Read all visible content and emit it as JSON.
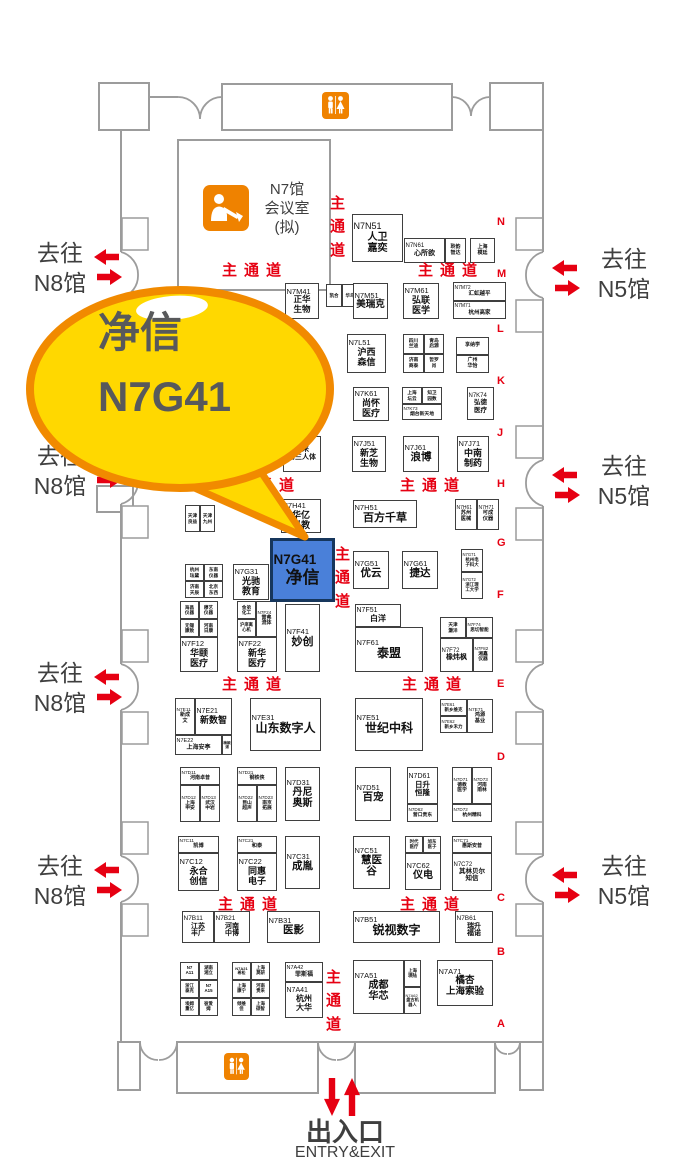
{
  "colors": {
    "red": "#e60012",
    "booth_blue": "#4a80d9",
    "booth_blue_border": "#16365c",
    "bubble_fill": "#ffd800",
    "bubble_stroke": "#f18a00",
    "facility_orange": "#ef8200",
    "wall_gray": "#9c9c9c",
    "text_dark": "#3f3f3f",
    "bubble_text": "#58595b"
  },
  "callout": {
    "name": "净信",
    "booth": "N7G41"
  },
  "conference_room": {
    "lines": [
      "N7馆",
      "会议室",
      "(拟)"
    ]
  },
  "icons": {
    "restroom": "wc-restroom",
    "conference": "presentation-speaker",
    "gate_arrows": "block-arrows",
    "entry_arrows": "up-down-arrows"
  },
  "aisle_label": "主通道",
  "aisles": {
    "h": [
      [
        222,
        259
      ],
      [
        418,
        259
      ],
      [
        235,
        474
      ],
      [
        400,
        474
      ],
      [
        222,
        673
      ],
      [
        402,
        673
      ],
      [
        218,
        893
      ],
      [
        400,
        893
      ]
    ],
    "v": [
      [
        329,
        192
      ],
      [
        334,
        543
      ],
      [
        325,
        966
      ]
    ]
  },
  "row_letters": [
    {
      "ch": "N",
      "y": 216
    },
    {
      "ch": "M",
      "y": 268
    },
    {
      "ch": "L",
      "y": 323
    },
    {
      "ch": "K",
      "y": 375
    },
    {
      "ch": "J",
      "y": 427
    },
    {
      "ch": "H",
      "y": 478
    },
    {
      "ch": "G",
      "y": 537
    },
    {
      "ch": "F",
      "y": 589
    },
    {
      "ch": "E",
      "y": 678
    },
    {
      "ch": "D",
      "y": 751
    },
    {
      "ch": "C",
      "y": 892
    },
    {
      "ch": "B",
      "y": 946
    },
    {
      "ch": "A",
      "y": 1018
    }
  ],
  "gates": {
    "left": {
      "lines": [
        "去往",
        "N8馆"
      ],
      "tops": [
        238,
        441,
        658,
        851
      ]
    },
    "right": {
      "lines": [
        "去往",
        "N5馆"
      ],
      "tops": [
        244,
        451,
        851
      ]
    }
  },
  "entry": {
    "cn": "出入口",
    "en": "ENTRY&EXIT"
  },
  "booths": [
    {
      "x": 352,
      "y": 214,
      "w": 51,
      "h": 48,
      "c": "N7N51",
      "n": [
        "人卫",
        "嘉奕"
      ],
      "cf": 9,
      "nf": 10
    },
    {
      "x": 404,
      "y": 238,
      "w": 41,
      "h": 25,
      "c": "N7N61",
      "n": [
        "心所欲"
      ],
      "cf": 6,
      "nf": 7
    },
    {
      "x": 445,
      "y": 238,
      "w": 21,
      "h": 25,
      "n": [
        "聆韵",
        "智达"
      ],
      "nf": 5
    },
    {
      "x": 470,
      "y": 238,
      "w": 25,
      "h": 25,
      "n": [
        "上海",
        "模廷"
      ],
      "nf": 5
    },
    {
      "x": 326,
      "y": 284,
      "w": 16,
      "h": 23,
      "n": [
        "凯合"
      ],
      "nf": 4.5
    },
    {
      "x": 342,
      "y": 284,
      "w": 16,
      "h": 23,
      "n": [
        "华鸟"
      ],
      "nf": 4.5
    },
    {
      "x": 285,
      "y": 283,
      "w": 34,
      "h": 36,
      "c": "N7M41",
      "n": [
        "正华",
        "生物"
      ],
      "cf": 7.5,
      "nf": 8.5
    },
    {
      "x": 353,
      "y": 283,
      "w": 35,
      "h": 36,
      "c": "N7M51",
      "n": [
        "美瑞克"
      ],
      "nf": 9.5
    },
    {
      "x": 403,
      "y": 283,
      "w": 36,
      "h": 36,
      "c": "N7M61",
      "n": [
        "弘联",
        "医学"
      ],
      "nf": 9
    },
    {
      "x": 453,
      "y": 282,
      "w": 53,
      "h": 19,
      "c": "N7M72",
      "n": [
        "汇虹越平"
      ],
      "cf": 5,
      "nf": 5.5
    },
    {
      "x": 453,
      "y": 301,
      "w": 53,
      "h": 18,
      "c": "N7M71",
      "n": [
        "杭州高家"
      ],
      "cf": 5,
      "nf": 5.5
    },
    {
      "x": 347,
      "y": 334,
      "w": 39,
      "h": 39,
      "c": "N7L51",
      "n": [
        "沪西",
        "森信"
      ],
      "nf": 9
    },
    {
      "x": 403,
      "y": 334,
      "w": 21,
      "h": 20,
      "n": [
        "四川",
        "兰迪"
      ],
      "nf": 4.8
    },
    {
      "x": 424,
      "y": 334,
      "w": 20,
      "h": 20,
      "n": [
        "青岛",
        "启源"
      ],
      "nf": 4.8
    },
    {
      "x": 403,
      "y": 354,
      "w": 21,
      "h": 19,
      "n": [
        "济南",
        "商泰"
      ],
      "nf": 4.8
    },
    {
      "x": 424,
      "y": 354,
      "w": 20,
      "h": 19,
      "n": [
        "哲罗",
        "肖"
      ],
      "nf": 4.8
    },
    {
      "x": 456,
      "y": 337,
      "w": 33,
      "h": 18,
      "n": [
        "享纳学"
      ],
      "nf": 5
    },
    {
      "x": 456,
      "y": 355,
      "w": 33,
      "h": 18,
      "n": [
        "广州",
        "华怡"
      ],
      "nf": 5
    },
    {
      "x": 353,
      "y": 387,
      "w": 36,
      "h": 34,
      "c": "N7K61",
      "n": [
        "尚怀",
        "医疗"
      ],
      "nf": 9
    },
    {
      "x": 402,
      "y": 387,
      "w": 20,
      "h": 17,
      "n": [
        "上海",
        "坛云"
      ],
      "nf": 4.6
    },
    {
      "x": 422,
      "y": 387,
      "w": 20,
      "h": 17,
      "n": [
        "知卫",
        "园数"
      ],
      "nf": 4.6
    },
    {
      "x": 402,
      "y": 404,
      "w": 40,
      "h": 16,
      "c": "N7K73",
      "n": [
        "烟台新天地"
      ],
      "cf": 4.6,
      "nf": 4.8
    },
    {
      "x": 467,
      "y": 387,
      "w": 27,
      "h": 33,
      "c": "N7K74",
      "n": [
        "弘德",
        "医疗"
      ],
      "cf": 6,
      "nf": 6.5
    },
    {
      "x": 283,
      "y": 436,
      "w": 38,
      "h": 36,
      "n": [
        "未来",
        "第三人体"
      ],
      "nf": 7
    },
    {
      "x": 352,
      "y": 436,
      "w": 34,
      "h": 36,
      "c": "N7J51",
      "n": [
        "新芝",
        "生物"
      ],
      "nf": 9
    },
    {
      "x": 403,
      "y": 436,
      "w": 36,
      "h": 36,
      "c": "N7J61",
      "n": [
        "浪博"
      ],
      "nf": 10.5
    },
    {
      "x": 457,
      "y": 436,
      "w": 32,
      "h": 36,
      "c": "N7J71",
      "n": [
        "中南",
        "制药"
      ],
      "nf": 9
    },
    {
      "x": 185,
      "y": 505,
      "w": 15,
      "h": 27,
      "n": [
        "天津",
        "良益"
      ],
      "nf": 4.6
    },
    {
      "x": 200,
      "y": 505,
      "w": 15,
      "h": 27,
      "n": [
        "天津",
        "九州"
      ],
      "nf": 4.6
    },
    {
      "x": 281,
      "y": 499,
      "w": 40,
      "h": 34,
      "c": "N7H41",
      "n": [
        "华亿",
        "科教"
      ],
      "nf": 9
    },
    {
      "x": 353,
      "y": 500,
      "w": 64,
      "h": 28,
      "c": "N7H51",
      "n": [
        "百方千草"
      ],
      "nf": 11
    },
    {
      "x": 455,
      "y": 499,
      "w": 22,
      "h": 31,
      "c": "N7H61",
      "n": [
        "苏州",
        "医械"
      ],
      "cf": 5,
      "nf": 5.2
    },
    {
      "x": 477,
      "y": 499,
      "w": 22,
      "h": 31,
      "c": "N7H71",
      "n": [
        "可成",
        "仪器"
      ],
      "cf": 5,
      "nf": 5.2
    },
    {
      "x": 185,
      "y": 564,
      "w": 19,
      "h": 17,
      "n": [
        "杭州",
        "珐黛"
      ],
      "nf": 4.6
    },
    {
      "x": 204,
      "y": 564,
      "w": 19,
      "h": 17,
      "n": [
        "东南",
        "仪器"
      ],
      "nf": 4.6
    },
    {
      "x": 185,
      "y": 581,
      "w": 19,
      "h": 17,
      "n": [
        "济南",
        "天辰"
      ],
      "nf": 4.6
    },
    {
      "x": 204,
      "y": 581,
      "w": 19,
      "h": 17,
      "n": [
        "北京",
        "东西"
      ],
      "nf": 4.6
    },
    {
      "x": 233,
      "y": 564,
      "w": 36,
      "h": 36,
      "c": "N7G31",
      "n": [
        "光驰",
        "教育"
      ],
      "nf": 9
    },
    {
      "x": 270,
      "y": 538,
      "w": 65,
      "h": 64,
      "c": "N7G41",
      "n": [
        "净信"
      ],
      "cf": 13.5,
      "nf": 17,
      "cls": "hl"
    },
    {
      "x": 353,
      "y": 551,
      "w": 36,
      "h": 38,
      "c": "N7G51",
      "n": [
        "优云"
      ],
      "nf": 10.5
    },
    {
      "x": 402,
      "y": 551,
      "w": 36,
      "h": 38,
      "c": "N7G61",
      "n": [
        "捷达"
      ],
      "nf": 10.5
    },
    {
      "x": 461,
      "y": 549,
      "w": 22,
      "h": 23,
      "c": "N7G71",
      "n": [
        "杭州电",
        "子科大"
      ],
      "cf": 4.2,
      "nf": 4.4
    },
    {
      "x": 461,
      "y": 572,
      "w": 22,
      "h": 27,
      "c": "N7G72",
      "n": [
        "浙江理",
        "工大学"
      ],
      "cf": 4.2,
      "nf": 4.4
    },
    {
      "x": 180,
      "y": 601,
      "w": 19,
      "h": 18,
      "n": [
        "海昌",
        "仪器"
      ],
      "nf": 4.6
    },
    {
      "x": 199,
      "y": 601,
      "w": 19,
      "h": 18,
      "n": [
        "穆艺",
        "仪器"
      ],
      "nf": 4.6
    },
    {
      "x": 180,
      "y": 619,
      "w": 19,
      "h": 18,
      "n": [
        "无锡",
        "康致"
      ],
      "nf": 4.6
    },
    {
      "x": 199,
      "y": 619,
      "w": 19,
      "h": 18,
      "n": [
        "河南",
        "日康"
      ],
      "nf": 4.6
    },
    {
      "x": 180,
      "y": 637,
      "w": 38,
      "h": 35,
      "c": "N7F12",
      "n": [
        "华颐",
        "医疗"
      ],
      "nf": 9
    },
    {
      "x": 237,
      "y": 601,
      "w": 19,
      "h": 18,
      "n": [
        "金弟",
        "化工"
      ],
      "nf": 4.6
    },
    {
      "x": 237,
      "y": 619,
      "w": 19,
      "h": 18,
      "n": [
        "沪庠离",
        "心机"
      ],
      "nf": 4.3
    },
    {
      "x": 256,
      "y": 601,
      "w": 21,
      "h": 36,
      "c": "N7F24",
      "n": [
        "雷弗",
        "流体"
      ],
      "cf": 4.6,
      "nf": 5
    },
    {
      "x": 237,
      "y": 637,
      "w": 40,
      "h": 35,
      "c": "N7F22",
      "n": [
        "新华",
        "医疗"
      ],
      "nf": 9
    },
    {
      "x": 285,
      "y": 604,
      "w": 35,
      "h": 68,
      "c": "N7F41",
      "n": [
        "妙创"
      ],
      "nf": 11
    },
    {
      "x": 355,
      "y": 604,
      "w": 46,
      "h": 23,
      "c": "N7F51",
      "n": [
        "白洋"
      ],
      "cf": 7,
      "nf": 8
    },
    {
      "x": 355,
      "y": 627,
      "w": 68,
      "h": 45,
      "c": "N7F61",
      "n": [
        "泰盟"
      ],
      "nf": 12
    },
    {
      "x": 440,
      "y": 617,
      "w": 26,
      "h": 21,
      "n": [
        "天津",
        "灏洋"
      ],
      "nf": 4.6
    },
    {
      "x": 466,
      "y": 617,
      "w": 27,
      "h": 21,
      "c": "N7F74",
      "n": [
        "思切智能"
      ],
      "cf": 4.4,
      "nf": 4.6
    },
    {
      "x": 440,
      "y": 638,
      "w": 33,
      "h": 34,
      "c": "N7F72",
      "n": [
        "橡炜枫"
      ],
      "cf": 6,
      "nf": 7
    },
    {
      "x": 473,
      "y": 638,
      "w": 20,
      "h": 34,
      "c": "N7F82",
      "n": [
        "湘鑫",
        "仪器"
      ],
      "cf": 4.6,
      "nf": 4.8
    },
    {
      "x": 175,
      "y": 698,
      "w": 20,
      "h": 37,
      "c": "N7E11",
      "n": [
        "新成",
        "文"
      ],
      "cf": 4.8,
      "nf": 5
    },
    {
      "x": 195,
      "y": 698,
      "w": 37,
      "h": 37,
      "c": "N7E21",
      "n": [
        "新数智"
      ],
      "cf": 7,
      "nf": 9
    },
    {
      "x": 175,
      "y": 735,
      "w": 47,
      "h": 20,
      "c": "N7E22",
      "n": [
        "上海安亭"
      ],
      "cf": 5.5,
      "nf": 6
    },
    {
      "x": 222,
      "y": 735,
      "w": 10,
      "h": 20,
      "n": [
        "梅颖浦"
      ],
      "nf": 3.6
    },
    {
      "x": 250,
      "y": 698,
      "w": 71,
      "h": 53,
      "c": "N7E31",
      "n": [
        "山东数字人"
      ],
      "nf": 12
    },
    {
      "x": 355,
      "y": 698,
      "w": 68,
      "h": 53,
      "c": "N7E51",
      "n": [
        "世纪中科"
      ],
      "nf": 12
    },
    {
      "x": 440,
      "y": 699,
      "w": 27,
      "h": 17,
      "c": "N7E61",
      "n": [
        "新乡维克"
      ],
      "cf": 4.3,
      "nf": 4.5
    },
    {
      "x": 440,
      "y": 716,
      "w": 27,
      "h": 17,
      "c": "N7E62",
      "n": [
        "新乡禾力"
      ],
      "cf": 4.3,
      "nf": 4.5
    },
    {
      "x": 467,
      "y": 699,
      "w": 26,
      "h": 34,
      "c": "N7E71",
      "n": [
        "鸿源",
        "基业"
      ],
      "cf": 4.8,
      "nf": 5.2
    },
    {
      "x": 180,
      "y": 767,
      "w": 40,
      "h": 18,
      "c": "N7D11",
      "n": [
        "河南卓普"
      ],
      "cf": 4.8,
      "nf": 5
    },
    {
      "x": 180,
      "y": 785,
      "w": 20,
      "h": 37,
      "c": "N7D12",
      "n": [
        "上海",
        "申安"
      ],
      "cf": 4.6,
      "nf": 4.8
    },
    {
      "x": 200,
      "y": 785,
      "w": 20,
      "h": 37,
      "c": "N7D13",
      "n": [
        "武汉",
        "中岩"
      ],
      "cf": 4.6,
      "nf": 4.8
    },
    {
      "x": 237,
      "y": 767,
      "w": 40,
      "h": 18,
      "c": "N7D21",
      "n": [
        "钢铁侠"
      ],
      "cf": 4.8,
      "nf": 5
    },
    {
      "x": 237,
      "y": 785,
      "w": 20,
      "h": 37,
      "c": "N7D22",
      "n": [
        "昆山",
        "超声"
      ],
      "cf": 4.6,
      "nf": 4.8
    },
    {
      "x": 257,
      "y": 785,
      "w": 20,
      "h": 37,
      "c": "N7D23",
      "n": [
        "南京",
        "拓展"
      ],
      "cf": 4.6,
      "nf": 4.8
    },
    {
      "x": 285,
      "y": 767,
      "w": 35,
      "h": 54,
      "c": "N7D31",
      "n": [
        "丹尼",
        "奥斯"
      ],
      "nf": 10
    },
    {
      "x": 355,
      "y": 767,
      "w": 36,
      "h": 54,
      "c": "N7D51",
      "n": [
        "百宠"
      ],
      "nf": 10.5
    },
    {
      "x": 407,
      "y": 767,
      "w": 31,
      "h": 37,
      "c": "N7D61",
      "n": [
        "日升",
        "恒隆"
      ],
      "cf": 7,
      "nf": 7.5
    },
    {
      "x": 407,
      "y": 804,
      "w": 31,
      "h": 18,
      "c": "N7D62",
      "n": [
        "营口贵东"
      ],
      "cf": 4.6,
      "nf": 4.8
    },
    {
      "x": 452,
      "y": 767,
      "w": 20,
      "h": 37,
      "c": "N7D71",
      "n": [
        "德教",
        "医学"
      ],
      "cf": 4.6,
      "nf": 4.8
    },
    {
      "x": 472,
      "y": 767,
      "w": 20,
      "h": 37,
      "c": "N7D73",
      "n": [
        "河南",
        "雨林"
      ],
      "cf": 4.6,
      "nf": 4.8
    },
    {
      "x": 452,
      "y": 804,
      "w": 40,
      "h": 18,
      "c": "N7D72",
      "n": [
        "杭州精科"
      ],
      "cf": 4.6,
      "nf": 4.8
    },
    {
      "x": 178,
      "y": 836,
      "w": 41,
      "h": 17,
      "c": "N7C11",
      "n": [
        "凯博"
      ],
      "cf": 4.8,
      "nf": 5.2
    },
    {
      "x": 178,
      "y": 853,
      "w": 41,
      "h": 38,
      "c": "N7C12",
      "n": [
        "永合",
        "创信"
      ],
      "nf": 9
    },
    {
      "x": 237,
      "y": 836,
      "w": 40,
      "h": 17,
      "c": "N7C21",
      "n": [
        "和泰"
      ],
      "cf": 4.8,
      "nf": 5.2
    },
    {
      "x": 237,
      "y": 853,
      "w": 40,
      "h": 38,
      "c": "N7C22",
      "n": [
        "同惠",
        "电子"
      ],
      "nf": 9
    },
    {
      "x": 285,
      "y": 836,
      "w": 35,
      "h": 53,
      "c": "N7C31",
      "n": [
        "成胤"
      ],
      "nf": 10.5
    },
    {
      "x": 353,
      "y": 836,
      "w": 37,
      "h": 53,
      "c": "N7C51",
      "n": [
        "慧医",
        "谷"
      ],
      "nf": 10.5
    },
    {
      "x": 405,
      "y": 836,
      "w": 18,
      "h": 17,
      "n": [
        "时代",
        "医疗"
      ],
      "nf": 4.4
    },
    {
      "x": 423,
      "y": 836,
      "w": 18,
      "h": 17,
      "n": [
        "旭东",
        "医子"
      ],
      "nf": 4.4
    },
    {
      "x": 405,
      "y": 853,
      "w": 36,
      "h": 37,
      "c": "N7C62",
      "n": [
        "仪电"
      ],
      "nf": 10
    },
    {
      "x": 452,
      "y": 836,
      "w": 40,
      "h": 17,
      "c": "N7C71",
      "n": [
        "惠斯安普"
      ],
      "cf": 4.8,
      "nf": 5
    },
    {
      "x": 452,
      "y": 853,
      "w": 40,
      "h": 38,
      "c": "N7C72",
      "n": [
        "其林贝尔",
        "知信"
      ],
      "cf": 6,
      "nf": 6.5
    },
    {
      "x": 182,
      "y": 911,
      "w": 32,
      "h": 32,
      "c": "N7B11",
      "n": [
        "江苏",
        "丰广"
      ],
      "cf": 6.5,
      "nf": 7
    },
    {
      "x": 214,
      "y": 911,
      "w": 36,
      "h": 32,
      "c": "N7B21",
      "n": [
        "河南",
        "中博"
      ],
      "cf": 6.5,
      "nf": 7
    },
    {
      "x": 267,
      "y": 911,
      "w": 53,
      "h": 32,
      "c": "N7B31",
      "n": [
        "医影"
      ],
      "nf": 10.5
    },
    {
      "x": 353,
      "y": 911,
      "w": 87,
      "h": 32,
      "c": "N7B51",
      "n": [
        "锐视数字"
      ],
      "nf": 12
    },
    {
      "x": 455,
      "y": 911,
      "w": 38,
      "h": 32,
      "c": "N7B61",
      "n": [
        "瑞升",
        "福诺"
      ],
      "cf": 6.5,
      "nf": 7
    },
    {
      "x": 180,
      "y": 962,
      "w": 19,
      "h": 18,
      "n": [
        "N7",
        "A11"
      ],
      "nf": 4.4
    },
    {
      "x": 199,
      "y": 962,
      "w": 19,
      "h": 18,
      "n": [
        "湖南",
        "湘立"
      ],
      "nf": 4.4
    },
    {
      "x": 180,
      "y": 980,
      "w": 19,
      "h": 18,
      "n": [
        "浙江",
        "泰克"
      ],
      "nf": 4.4
    },
    {
      "x": 199,
      "y": 980,
      "w": 19,
      "h": 18,
      "n": [
        "N7",
        "A15"
      ],
      "nf": 4.4
    },
    {
      "x": 180,
      "y": 998,
      "w": 19,
      "h": 18,
      "n": [
        "埃姆",
        "重亿"
      ],
      "nf": 4.4
    },
    {
      "x": 199,
      "y": 998,
      "w": 19,
      "h": 18,
      "n": [
        "彼爱",
        "姆"
      ],
      "nf": 4.4
    },
    {
      "x": 232,
      "y": 962,
      "w": 19,
      "h": 18,
      "n": [
        "N7A21",
        "希松"
      ],
      "nf": 4
    },
    {
      "x": 251,
      "y": 962,
      "w": 19,
      "h": 18,
      "n": [
        "上海",
        "莫研"
      ],
      "nf": 4.4
    },
    {
      "x": 232,
      "y": 980,
      "w": 19,
      "h": 18,
      "n": [
        "上海",
        "康宁"
      ],
      "nf": 4.4
    },
    {
      "x": 251,
      "y": 980,
      "w": 19,
      "h": 18,
      "n": [
        "河南",
        "贵来"
      ],
      "nf": 4.4
    },
    {
      "x": 232,
      "y": 998,
      "w": 19,
      "h": 18,
      "n": [
        "倾维",
        "佳"
      ],
      "nf": 4.4
    },
    {
      "x": 251,
      "y": 998,
      "w": 19,
      "h": 18,
      "n": [
        "上海",
        "硕智"
      ],
      "nf": 4.4
    },
    {
      "x": 285,
      "y": 962,
      "w": 38,
      "h": 20,
      "c": "N7A42",
      "n": [
        "菲斯福"
      ],
      "cf": 5.5,
      "nf": 6
    },
    {
      "x": 285,
      "y": 982,
      "w": 38,
      "h": 36,
      "c": "N7A41",
      "n": [
        "杭州",
        "大华"
      ],
      "cf": 7,
      "nf": 8
    },
    {
      "x": 353,
      "y": 960,
      "w": 51,
      "h": 54,
      "c": "N7A51",
      "n": [
        "成都",
        "华芯"
      ],
      "nf": 10
    },
    {
      "x": 404,
      "y": 960,
      "w": 17,
      "h": 27,
      "n": [
        "上海",
        "瑛陆"
      ],
      "nf": 4.4
    },
    {
      "x": 404,
      "y": 987,
      "w": 17,
      "h": 27,
      "c": "N7A62",
      "n": [
        "盘古机",
        "器人"
      ],
      "cf": 4,
      "nf": 4.2
    },
    {
      "x": 437,
      "y": 960,
      "w": 56,
      "h": 46,
      "c": "N7A71",
      "n": [
        "橘杏",
        "上海索验"
      ],
      "nf": 9.5
    }
  ]
}
